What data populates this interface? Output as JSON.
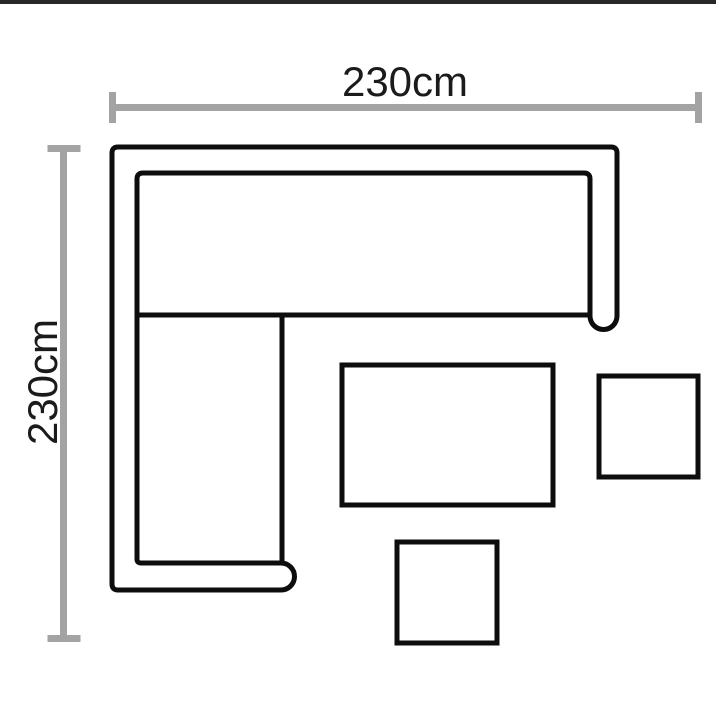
{
  "colors": {
    "background": "#ffffff",
    "top-bar": "#282828",
    "outline": "#0d0d0d",
    "dimension": "#a3a3a3",
    "label": "#1b1b1b"
  },
  "diagram": {
    "type": "corner-sofa-set-dimension-diagram",
    "width_dimension": {
      "label": "230cm",
      "orientation": "horizontal",
      "position": "top"
    },
    "height_dimension": {
      "label": "230cm",
      "orientation": "vertical",
      "position": "left"
    },
    "shapes": [
      {
        "name": "corner-sofa-outline",
        "kind": "l-shaped-outline-rounded-arms"
      },
      {
        "name": "coffee-table",
        "kind": "rectangle"
      },
      {
        "name": "side-table",
        "kind": "square"
      },
      {
        "name": "footstool",
        "kind": "square"
      }
    ]
  }
}
